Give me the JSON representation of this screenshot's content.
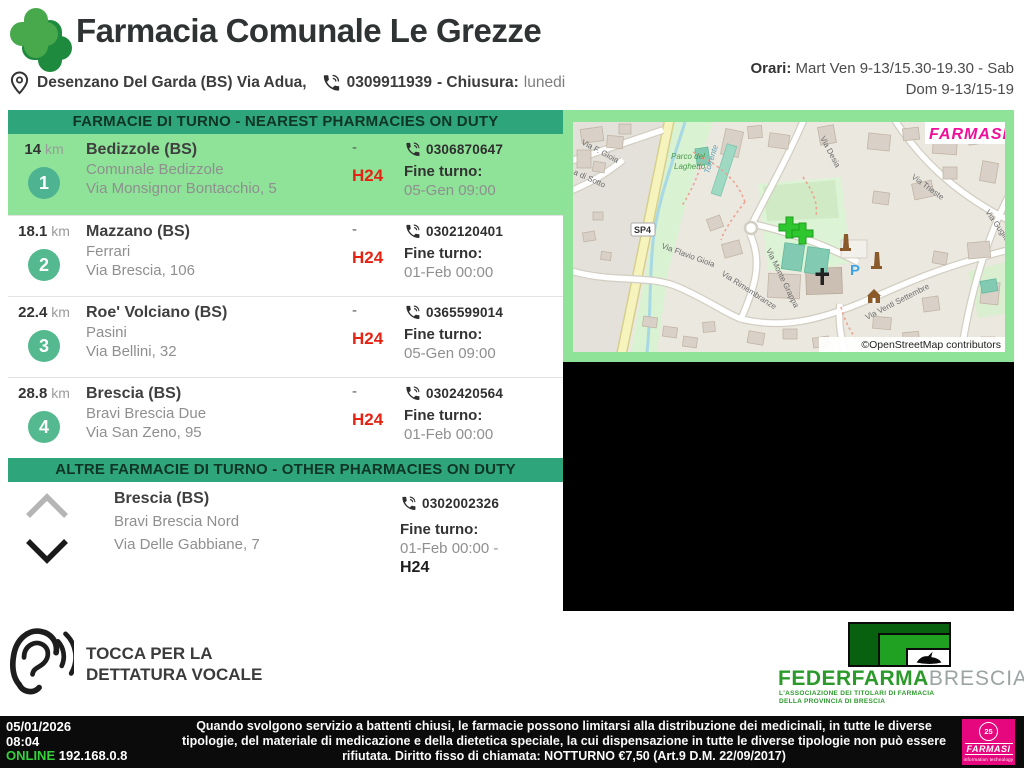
{
  "header": {
    "title": "Farmacia Comunale Le Grezze",
    "address": "Desenzano Del Garda (BS) Via Adua,",
    "phone": "0309911939",
    "closure_label": "- Chiusura:",
    "closure_value": "lunedi",
    "hours_label": "Orari:",
    "hours_line1": " Mart Ven 9-13/15.30-19.30 - Sab",
    "hours_line2": "Dom 9-13/15-19"
  },
  "duty": {
    "banner": "FARMACIE DI TURNO - NEAREST PHARMACIES ON DUTY",
    "rows": [
      {
        "distance": "14",
        "unit": " km",
        "num": "1",
        "city": "Bedizzole (BS)",
        "name": "Comunale Bedizzole",
        "address": "Via Monsignor Bontacchio, 5",
        "dash": "-",
        "h24": "H24",
        "phone": "0306870647",
        "fine_label": "Fine turno:",
        "fine": "05-Gen 09:00"
      },
      {
        "distance": "18.1",
        "unit": " km",
        "num": "2",
        "city": "Mazzano (BS)",
        "name": "Ferrari",
        "address": "Via Brescia, 106",
        "dash": "-",
        "h24": "H24",
        "phone": "0302120401",
        "fine_label": "Fine turno:",
        "fine": "01-Feb 00:00"
      },
      {
        "distance": "22.4",
        "unit": " km",
        "num": "3",
        "city": "Roe' Volciano (BS)",
        "name": "Pasini",
        "address": "Via Bellini, 32",
        "dash": "-",
        "h24": "H24",
        "phone": "0365599014",
        "fine_label": "Fine turno:",
        "fine": "05-Gen 09:00"
      },
      {
        "distance": "28.8",
        "unit": " km",
        "num": "4",
        "city": "Brescia (BS)",
        "name": "Bravi Brescia Due",
        "address": "Via San Zeno, 95",
        "dash": "-",
        "h24": "H24",
        "phone": "0302420564",
        "fine_label": "Fine turno:",
        "fine": "01-Feb 00:00"
      }
    ]
  },
  "other": {
    "banner": "ALTRE FARMACIE DI TURNO - OTHER PHARMACIES ON DUTY",
    "row": {
      "city": "Brescia (BS)",
      "name": "Bravi Brescia Nord",
      "address": "Via Delle Gabbiane, 7",
      "phone": "0302002326",
      "fine_label": "Fine turno:",
      "fine": "01-Feb 00:00 -",
      "h24": "H24"
    }
  },
  "voice": {
    "line1": "TOCCA PER LA",
    "line2": "DETTATURA VOCALE"
  },
  "map": {
    "watermark": "FARMASI",
    "attribution": "©OpenStreetMap contributors",
    "sp4": "SP4",
    "parking": "P",
    "labels": [
      "Via F. Gioia",
      "a di Sotto",
      "Torrente",
      "Parco del",
      "Laghetto",
      "Via Flavio Gioia",
      "Via Desia",
      "Via Trieste",
      "Via Guglielmo M",
      "Via Monte Grappa",
      "Via Rimembranze",
      "Via Venti Settembre"
    ]
  },
  "federfarma": {
    "name": "FEDERFARMA",
    "region": "BRESCIA",
    "sub1": "L'ASSOCIAZIONE DEI TITOLARI DI FARMACIA",
    "sub2": "DELLA PROVINCIA DI BRESCIA"
  },
  "statusbar": {
    "date": "05/01/2026",
    "time": "08:04",
    "online": "ONLINE",
    "ip": " 192.168.0.8",
    "notice": "Quando svolgono servizio a battenti chiusi, le farmacie possono limitarsi alla distribuzione dei medicinali, in tutte le diverse tipologie, del materiale di medicazione e della dietetica speciale, la cui dispensazione in tutte le diverse tipologie non può essere rifiutata. Diritto fisso di chiamata: NOTTURNO €7,50 (Art.9 D.M. 22/09/2017)"
  },
  "farmasi_badge": {
    "anniversary": "25",
    "name": "FARMASI",
    "tagline": "information technology"
  },
  "colors": {
    "accent_teal": "#2fa57b",
    "highlight_green": "#8ee398",
    "circle_green": "#54b98e",
    "h24_red": "#e42313",
    "farmasi_magenta": "#e6077e",
    "federfarma_green": "#2b9a2b"
  }
}
